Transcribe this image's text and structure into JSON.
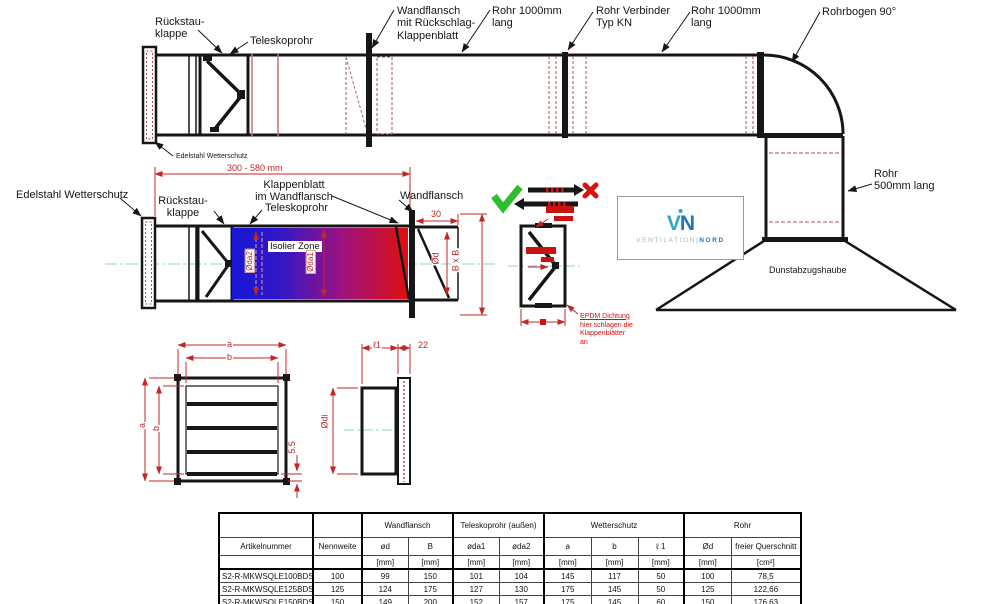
{
  "drawing_labels": {
    "top": {
      "rueckstauklappe": "Rückstau-\nklappe",
      "teleskoprohr": "Teleskoprohr",
      "wandflansch_klappenblatt": "Wandflansch\nmit Rückschlag-\nKlappenblatt",
      "rohr1000_a": "Rohr 1000mm\nlang",
      "rohr_verbinder": "Rohr Verbinder\nTyp KN",
      "rohr1000_b": "Rohr 1000mm\nlang",
      "rohrbogen": "Rohrbogen 90°",
      "edelstahl_wetterschutz": "Edelstahl Wetterschutz",
      "rohr500": "Rohr\n500mm lang",
      "dunstabzugshaube": "Dunstabzugshaube"
    },
    "section": {
      "edelstahl_wetterschutz": "Edelstahl Wetterschutz",
      "rueckstauklappe": "Rückstau-\nklappe",
      "dim_laenge": "300 - 580 mm",
      "klappenblatt": "Klappenblatt\nim Wandflansch",
      "teleskoprohr": "Teleskoprohr",
      "wandflansch": "Wandflansch",
      "isolier_zone": "Isolier Zone",
      "dim_oda2": "Øda2",
      "dim_oda1": "Øda1",
      "dim_30": "30",
      "dim_od": "Ød",
      "dim_bxb": "B x B"
    },
    "valve_detail": {
      "epdm_line1": "EPDM Dichtung",
      "epdm_rest": "hier schlagen die\nKlappenblätter\nan"
    },
    "wetterschutz_views": {
      "dim_a_top": "a",
      "dim_b_top": "b",
      "dim_a_left": "a",
      "dim_b_left": "b",
      "dim_5_5": "5.5",
      "dim_l1": "ℓ1",
      "dim_22": "22",
      "dim_odi": "Ødi"
    }
  },
  "logo": {
    "letter_v": "V",
    "letter_n": "N",
    "word_left": "VENTILATION",
    "divider": "|",
    "word_right": "NORD"
  },
  "table": {
    "group_headers": {
      "wandflansch": "Wandflansch",
      "teleskoprohr": "Teleskoprohr (außen)",
      "wetterschutz": "Wetterschutz",
      "rohr": "Rohr"
    },
    "columns": [
      "Artikelnummer",
      "Nennweite",
      "ød",
      "B",
      "øda1",
      "øda2",
      "a",
      "b",
      "ℓ 1",
      "Ød",
      "freier Querschnitt"
    ],
    "units": [
      "",
      "",
      "[mm]",
      "[mm]",
      "[mm]",
      "[mm]",
      "[mm]",
      "[mm]",
      "[mm]",
      "[mm]",
      "[cm²]"
    ],
    "rows": [
      [
        "S2-R-MKWSQLE100BDSI",
        "100",
        "99",
        "150",
        "101",
        "104",
        "145",
        "117",
        "50",
        "100",
        "78,5"
      ],
      [
        "S2-R-MKWSQLE125BDSI",
        "125",
        "124",
        "175",
        "127",
        "130",
        "175",
        "145",
        "50",
        "125",
        "122,66"
      ],
      [
        "S2-R-MKWSQLE150BDSI",
        "150",
        "149",
        "200",
        "152",
        "157",
        "175",
        "145",
        "60",
        "150",
        "176,63"
      ]
    ]
  },
  "colors": {
    "dimension_red": "#c22727",
    "hatch_red": "#b05050",
    "centerline_cyan": "#8fd0d0",
    "isolier_gradient_blue": "#1717d6",
    "isolier_gradient_red": "#de0f0f",
    "check_green": "#2ebd2e",
    "alert_red": "#cc1111",
    "logo_teal": "#2fa8c4",
    "logo_blue": "#1b75bc"
  }
}
